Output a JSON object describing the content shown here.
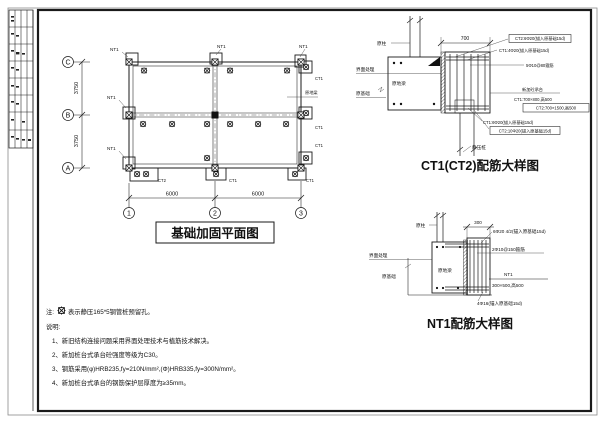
{
  "plan": {
    "title": "基础加固平面图",
    "rows": [
      "C",
      "B",
      "A"
    ],
    "cols": [
      "1",
      "2",
      "3"
    ],
    "dim_row": "3750",
    "dim_col": "6000",
    "labels": {
      "nt1": "NT1",
      "ct1": "CT1",
      "ct2": "CT2",
      "beam": "原地梁"
    }
  },
  "ct": {
    "title": "CT1(CT2)配筋大样图",
    "dim_top": "700",
    "col": "原柱",
    "interface": "界面处理",
    "beam": "原地梁",
    "foundation": "原基础",
    "cap": "新加砼承台",
    "pile": "静压桩",
    "top_boxed": "CT2:6Φ20(锚入原基础15d)",
    "top_plain": "CT1:4Φ20(锚入原基础15d)",
    "stirrup": "5Φ10@80箍筋",
    "size1": "CT1:700×800,高500",
    "size2": "CT2:700×1500,高500",
    "bot_plain": "CT1:6Φ20(锚入原基础15d)",
    "bot_boxed": "CT2:10Φ20(锚入原基础15d)"
  },
  "nt": {
    "title": "NT1配筋大样图",
    "dim_top": "300",
    "col": "原柱",
    "interface": "界面处理",
    "beam": "原地梁",
    "foundation": "原基础",
    "bar_top": "6Φ20 4/2(锚入原基础15d)",
    "stirrup": "2Φ10@150箍筋",
    "name": "NT1",
    "size": "300×500,高500",
    "bar_bot": "4Φ16(锚入原基础15d)"
  },
  "notes": {
    "prefix": "注:",
    "symbol_text": "表示静压165*5钢管桩预留孔。",
    "heading": "说明:",
    "items": [
      "1、新旧结构连接问题采用界面处理技术与植筋技术解决。",
      "2、新加桩台式承台砼强度等级为C30。",
      "3、钢筋采用(φ)HRB235,fy=210N/mm²,(Φ)HRB335,fy=300N/mm²。",
      "4、新加桩台式承台的钢筋保护层厚度为≥35mm。"
    ]
  }
}
